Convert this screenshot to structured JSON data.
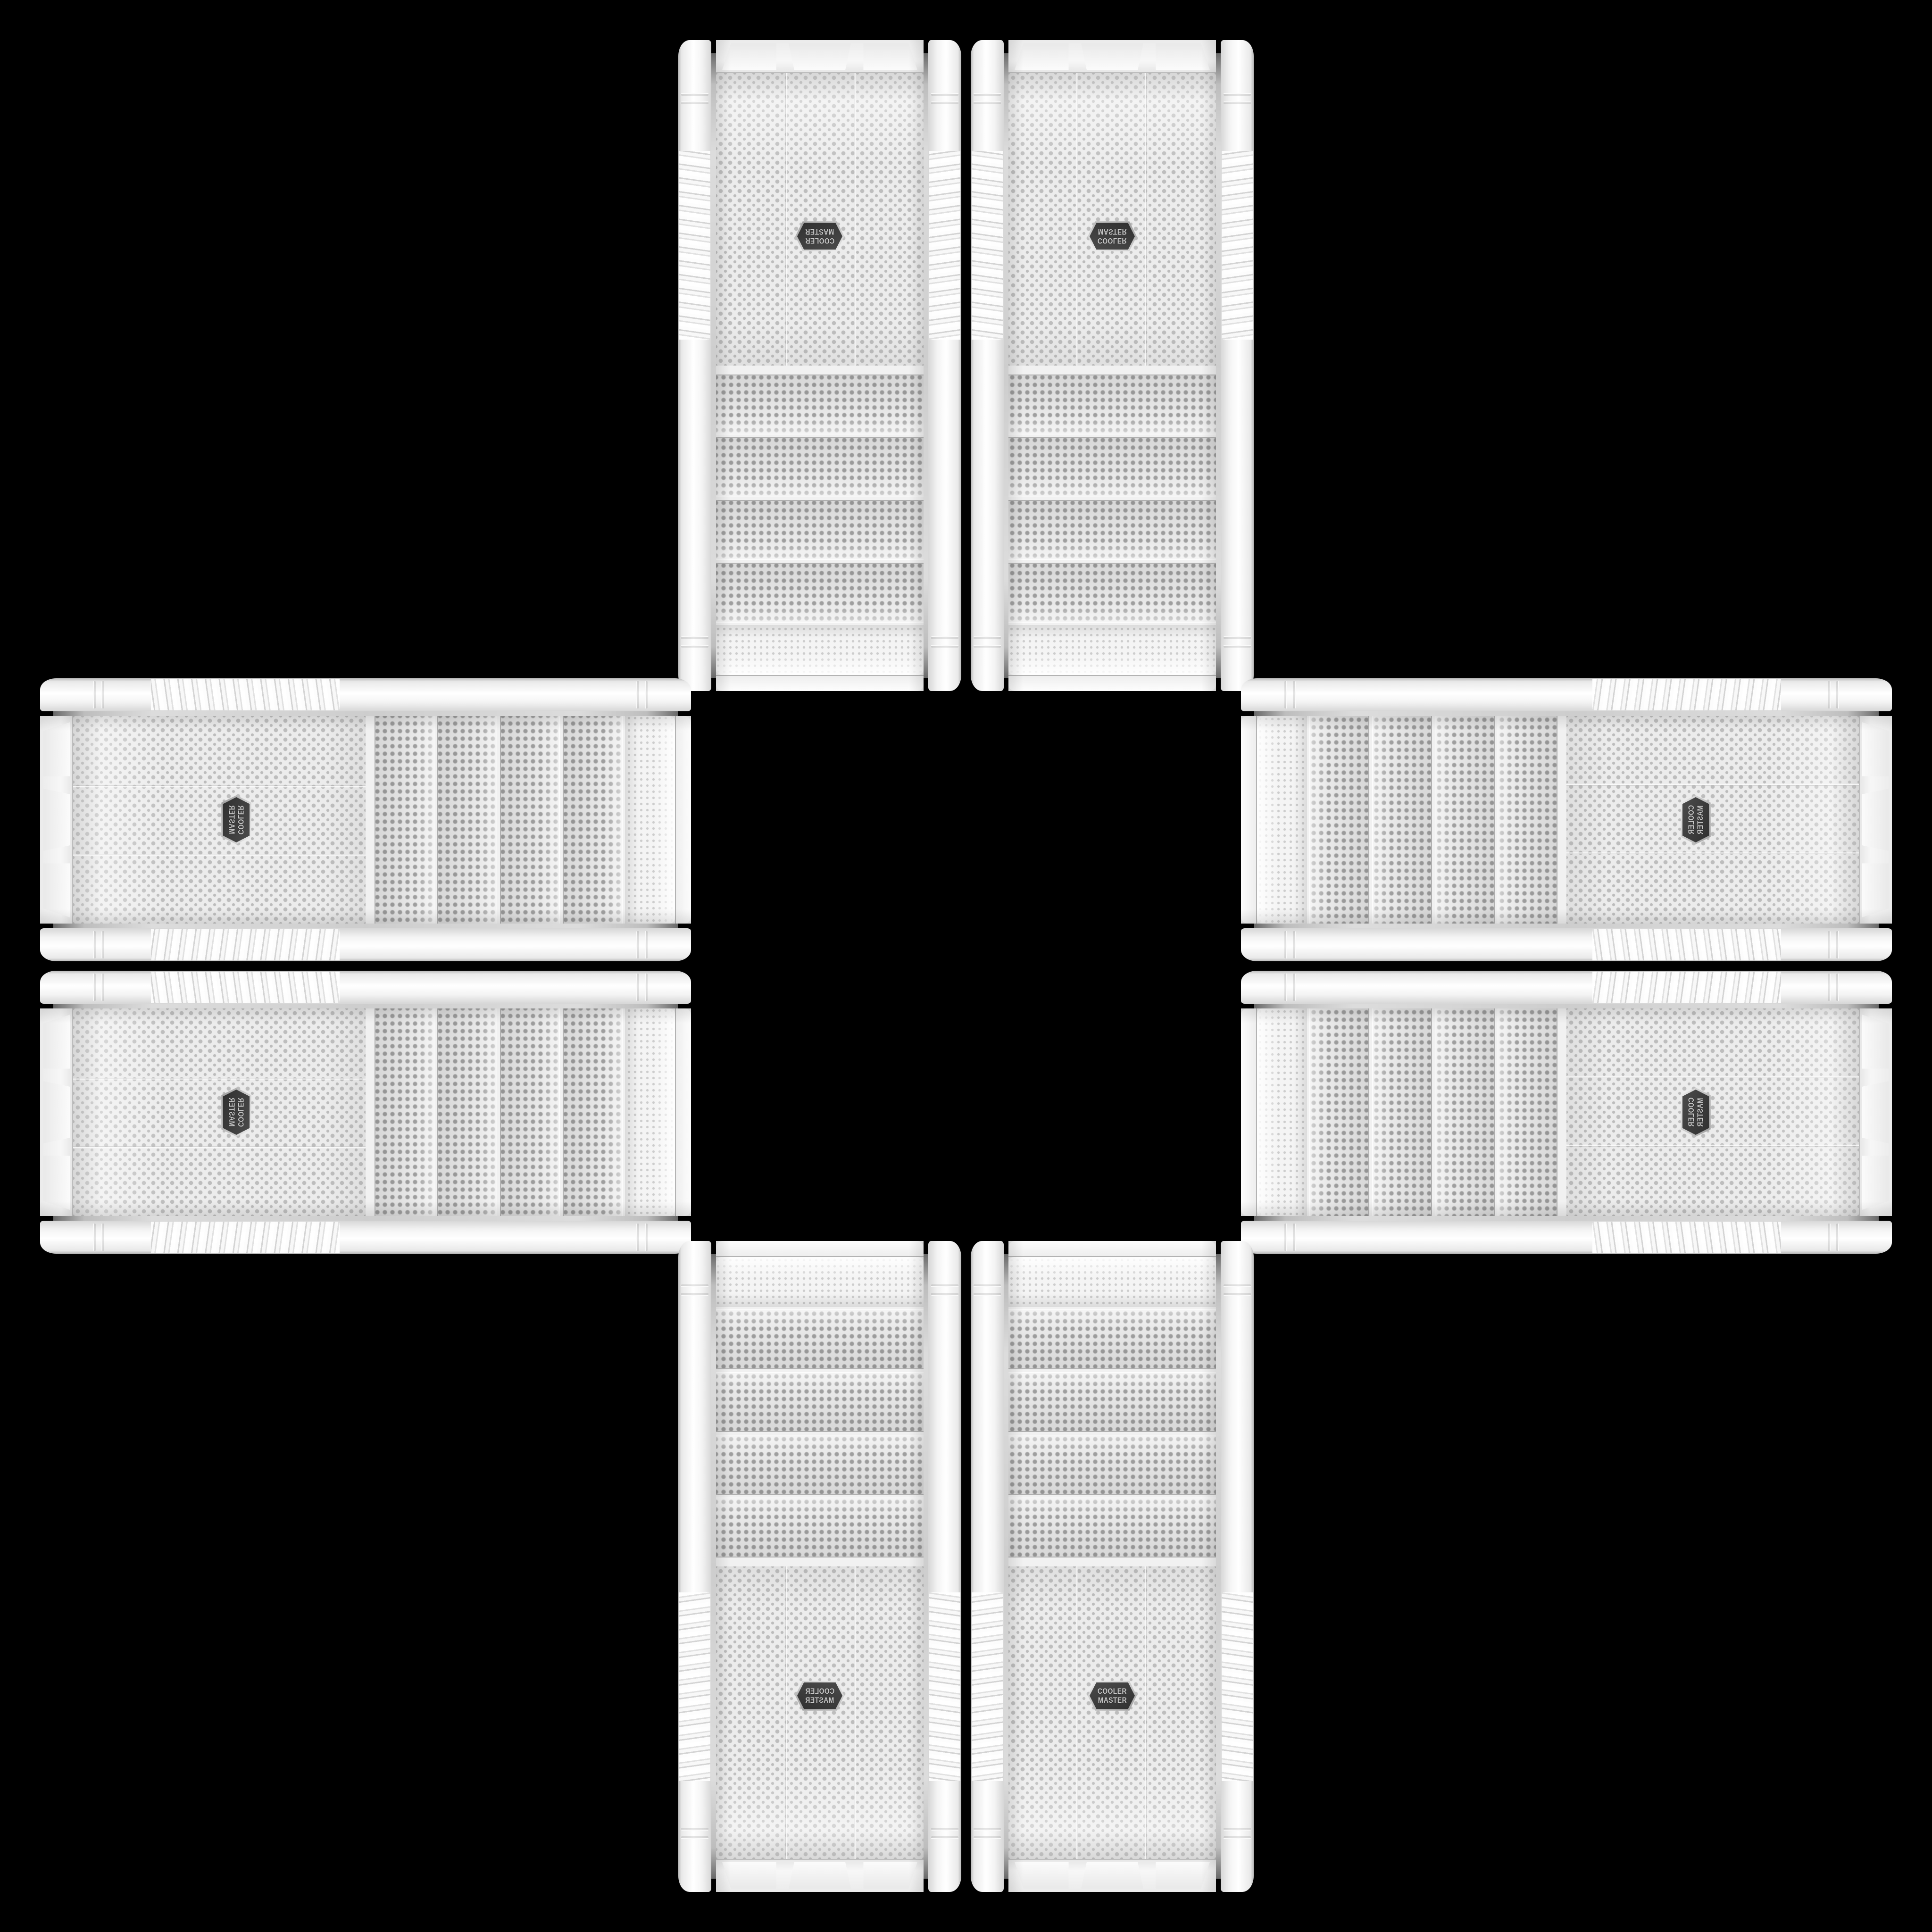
{
  "background_color": "#000000",
  "badge": {
    "line1": "COOLER",
    "line2": "MASTER",
    "icon": "hexagon-badge-icon",
    "bg_color": "#3d3d3d",
    "text_color": "#c9c9c9",
    "rim_color": "#d8d8d8"
  },
  "colors": {
    "case_body": "#f2f2f2",
    "mesh_base": "#ececec",
    "mesh_dot": "#bdbdbd",
    "bay_strip_base": "#e9e9e9",
    "bay_strip_dot": "#9f9f9f",
    "chrome_seam": "#c7c7c7",
    "trim_highlight": "#ffffff",
    "trim_shadow": "#b9b9b9"
  },
  "cases": [
    {
      "id": "top-left",
      "orientation": "rotated-180"
    },
    {
      "id": "top-right",
      "orientation": "flipped-vertical"
    },
    {
      "id": "left-top",
      "orientation": "mirrored-anti-diagonal-cap-left"
    },
    {
      "id": "left-bottom",
      "orientation": "mirrored-anti-diagonal-cap-left"
    },
    {
      "id": "right-top",
      "orientation": "mirrored-main-diagonal-cap-right"
    },
    {
      "id": "right-bottom",
      "orientation": "mirrored-main-diagonal-cap-right"
    },
    {
      "id": "bottom-left",
      "orientation": "flipped-horizontal"
    },
    {
      "id": "bottom-right",
      "orientation": "upright"
    }
  ]
}
